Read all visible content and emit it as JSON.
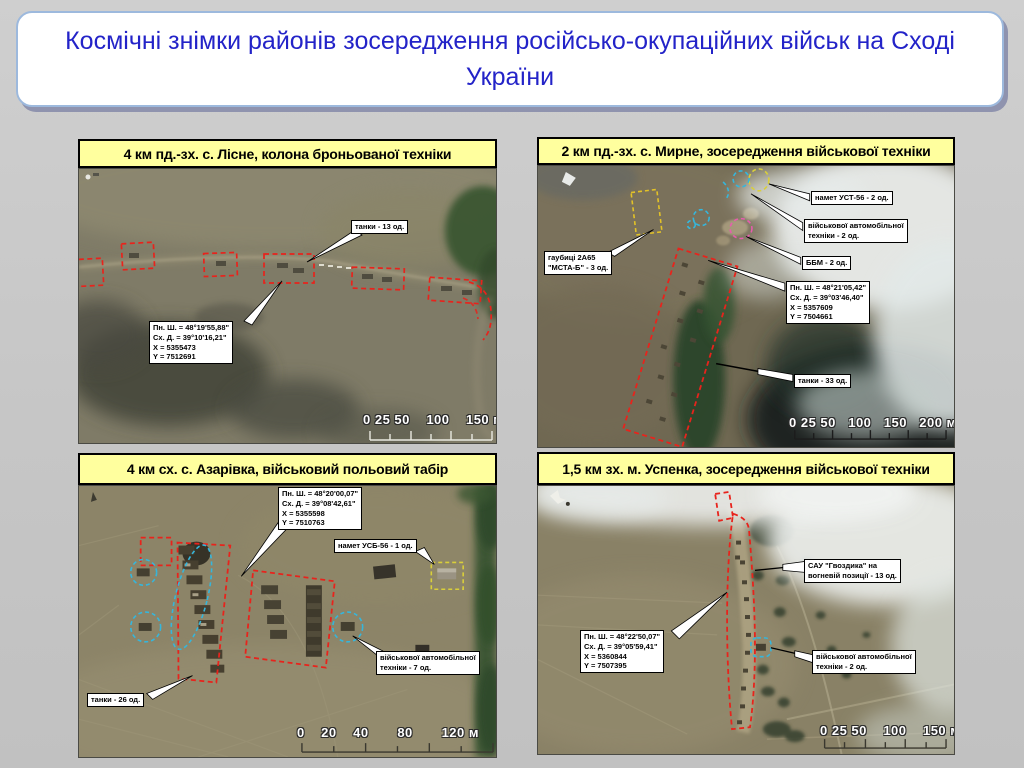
{
  "slide": {
    "title": "Космічні знімки районів зосередження російсько-окупаційних військ на Сході України"
  },
  "colors": {
    "background": "#c6c6c6",
    "title_text": "#2323c8",
    "panel_caption_bg": "#ffff9e",
    "annotation_red": "#e8231c",
    "annotation_yellow": "#e3c227",
    "annotation_cyan": "#35b6dc",
    "annotation_pink": "#e85cae"
  },
  "panels": [
    {
      "title": "4 км пд.-зх. с. Лісне, колона броньованої техніки",
      "callout_tanks": "танки - 13 од.",
      "coords": [
        "Пн. Ш. = 48°19'55,88\"",
        "Сх. Д. = 39°10'16,21\"",
        "X = 5355473",
        "Y = 7512691"
      ],
      "scale": "0 25 50    100    150 м"
    },
    {
      "title": "2 км пд.-зх. с. Мирне, зосередження військової техніки",
      "callout_tent": "намет УСТ-56 - 2 од.",
      "callout_auto": [
        "військової автомобільної",
        "техніки - 2 од."
      ],
      "callout_bbm": "ББМ - 2 од.",
      "callout_howitzer": [
        "гаубиці 2А65",
        "\"МСТА-Б\" - 3 од."
      ],
      "callout_tanks": "танки - 33 од.",
      "coords": [
        "Пн. Ш. = 48°21'05,42\"",
        "Сх. Д. = 39°03'46,40\"",
        "X = 5357609",
        "Y = 7504661"
      ],
      "scale": "0 25 50   100   150   200 м"
    },
    {
      "title": "4 км сх. с. Азарівка, військовий польовий табір",
      "callout_tent": "намет УСБ-56 - 1 од.",
      "callout_tanks": "танки - 26 од.",
      "callout_auto": [
        "військової автомобільної",
        "техніки - 7 од."
      ],
      "coords": [
        "Пн. Ш. = 48°20'00,07\"",
        "Сх. Д. = 39°08'42,61\"",
        "X = 5355598",
        "Y = 7510763"
      ],
      "scale": "0    20    40       80       120 м"
    },
    {
      "title": "1,5 км зх. м. Успенка, зосередження військової техніки",
      "callout_sau": [
        "САУ \"Гвоздика\" на",
        "вогневій позиції - 13 од."
      ],
      "callout_auto": [
        "військової автомобільної",
        "техніки - 2 од."
      ],
      "coords": [
        "Пн. Ш. = 48°22'50,07\"",
        "Сх. Д. = 39°05'59,41\"",
        "X = 5360844",
        "Y = 7507395"
      ],
      "scale": "0 25 50    100    150 м"
    }
  ]
}
